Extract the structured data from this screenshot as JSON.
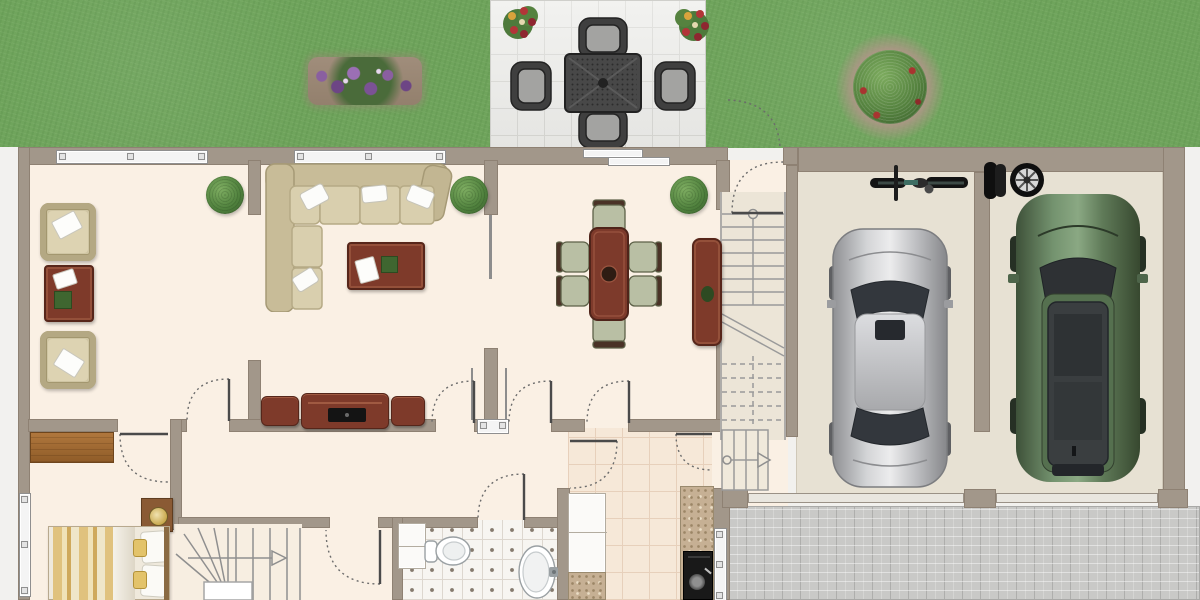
{
  "scene": {
    "type": "floor-plan",
    "view": "top-down",
    "label": "Ground floor plan with garden, patio, double garage and driveway"
  },
  "palette": {
    "grass": "#6fa45c",
    "patio_tile": "#ebebe8",
    "wall": "#a2978a",
    "floor_cream": "#faf0e4",
    "garage_floor": "#e7e1d3",
    "driveway_paver": "#c9c9c7",
    "bath_tile": "#f7f5f1",
    "kitchen_tile": "#f6e8d8",
    "dark_wood": "#7e3a2a",
    "light_wood": "#a9702f",
    "sofa_beige": "#cfc5a3",
    "car_silver": "#c0c1c4",
    "car_green": "#5d7d62"
  },
  "outdoor": {
    "lawn_label": "Lawn",
    "patio_label": "Patio",
    "flower_bed_label": "Flower bed",
    "shrub_label": "Garden shrub",
    "planter_label": "Flower planter",
    "patio_set_label": "Outdoor dining set (table + 4 chairs)",
    "gate_arc_label": "Gate swing"
  },
  "rooms": [
    {
      "id": "sitting-room",
      "label": "Sitting room",
      "furniture": [
        "armchair",
        "armchair",
        "square side table",
        "potted plant"
      ]
    },
    {
      "id": "living-room",
      "label": "Living room",
      "furniture": [
        "corner sofa",
        "coffee table",
        "media console with TV",
        "potted plant"
      ]
    },
    {
      "id": "dining-room",
      "label": "Dining room",
      "furniture": [
        "dining table for six",
        "sideboard",
        "potted plant"
      ]
    },
    {
      "id": "hallway",
      "label": "Hallway with staircase",
      "furniture": [
        "staircase",
        "front door"
      ]
    },
    {
      "id": "bedroom",
      "label": "Bedroom",
      "furniture": [
        "double bed",
        "bedside table",
        "desk"
      ]
    },
    {
      "id": "bathroom",
      "label": "Bathroom",
      "furniture": [
        "toilet",
        "washbasin",
        "cabinet"
      ]
    },
    {
      "id": "kitchen",
      "label": "Kitchen",
      "furniture": [
        "kitchen cabinets",
        "granite worktop",
        "range cooker"
      ]
    },
    {
      "id": "garage",
      "label": "Double garage",
      "furniture": [
        "bicycle",
        "spare wheels",
        "silver car",
        "green car"
      ]
    }
  ],
  "items": {
    "sofa": "Corner sofa",
    "coffee_table": "Coffee table",
    "media_console": "Media console with TV",
    "armchair": "Armchair",
    "side_table": "Side table",
    "dining_table": "Dining table with six chairs",
    "sideboard": "Sideboard",
    "bed": "Double bed",
    "desk": "Desk",
    "nightstand": "Bedside table",
    "toilet": "Toilet",
    "sink": "Washbasin",
    "bath_cabinet": "Bathroom cabinet",
    "kitchen_counter": "Kitchen cabinets",
    "worktop": "Granite worktop",
    "range": "Range cooker",
    "bike": "Bicycle",
    "tires": "Spare wheels",
    "car_silver": "Silver car",
    "car_green": "Green car",
    "stairs_main": "Main staircase",
    "stairs_lower": "Lower stair flight",
    "stairs_winder": "Winder staircase",
    "front_door": "Front door",
    "garage_door": "Garage door",
    "driveway": "Paved driveway",
    "window": "Window",
    "sliding_door": "Sliding patio door",
    "plant": "Potted plant"
  }
}
